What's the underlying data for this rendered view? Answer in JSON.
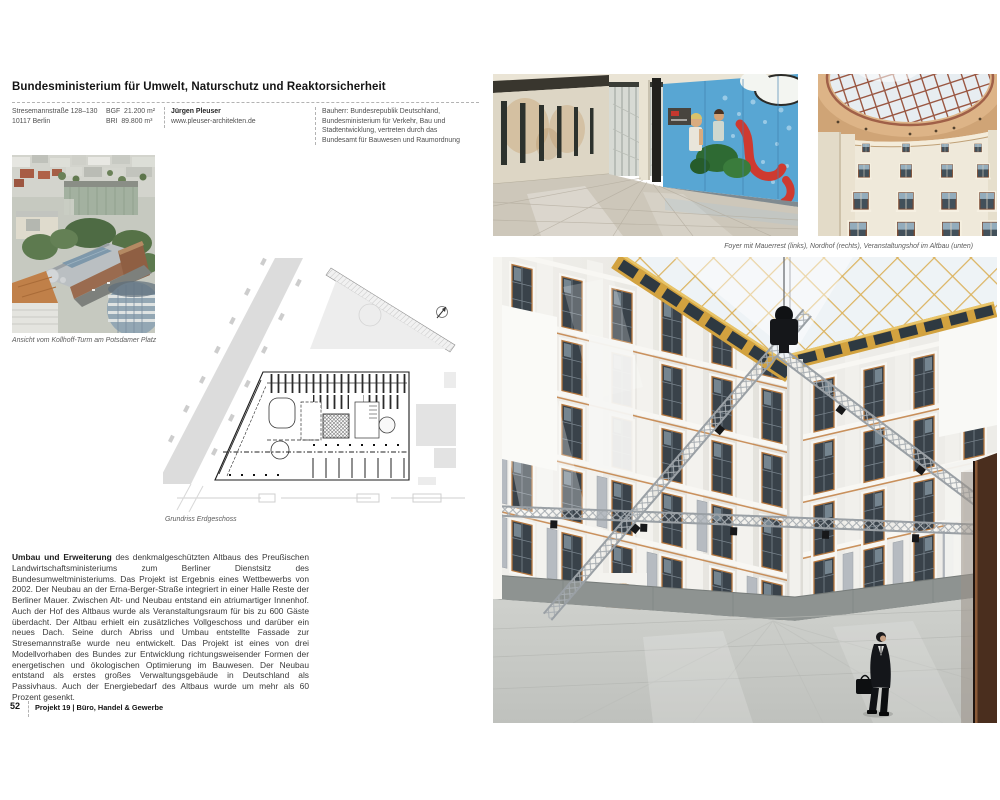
{
  "header": {
    "title": "Bundesministerium für Umwelt, Naturschutz und Reaktorsicherheit",
    "address_line1": "Stresemannstraße 128–130",
    "address_line2": "10117 Berlin",
    "metric1_label": "BGF",
    "metric1_value": "21.200 m²",
    "metric2_label": "BRI",
    "metric2_value": "89.800 m³",
    "architect_name": "Jürgen Pleuser",
    "architect_url": "www.pleuser-architekten.de",
    "client_lines": [
      "Bauherr: Bundesrepublik Deutschland,",
      "Bundesministerium für Verkehr, Bau und",
      "Stadtentwicklung, vertreten durch das",
      "Bundesamt für Bauwesen und Raumordnung"
    ]
  },
  "figures": {
    "aerial_caption": "Ansicht vom Kollhoff-Turm am Potsdamer Platz",
    "plan_caption": "Grundriss Erdgeschoss",
    "photos_caption": "Foyer mit Mauerrest (links), Nordhof (rechts), Veranstaltungshof im Altbau (unten)"
  },
  "body": {
    "lead": "Umbau und Erweiterung",
    "text": " des denkmalgeschützten Altbaus des Preußischen Landwirtschaftsministeriums zum Berliner Dienstsitz des Bundesumweltministeriums. Das Projekt ist Ergebnis eines Wettbewerbs von 2002. Der Neubau an der Erna-Berger-Straße integriert in einer Halle Reste der Berliner Mauer. Zwischen Alt- und Neubau entstand ein atriumartiger Innenhof. Auch der Hof des Altbaus wurde als Veranstaltungsraum für bis zu 600 Gäste überdacht. Der Altbau erhielt ein zusätzliches Vollgeschoss und darüber ein neues Dach. Seine durch Abriss und Umbau entstellte Fassade zur Stresemannstraße wurde neu entwickelt. Das Projekt ist eines von drei Modellvorhaben des Bundes zur Entwicklung richtungsweisender Formen der energetischen und ökologischen Optimierung im Bauwesen. Der Neubau entstand als erstes großes Verwaltungsgebäude in Deutschland als Passivhaus. Auch der Energiebedarf des Altbaus wurde um mehr als 60 Prozent gesenkt."
  },
  "footer": {
    "page_number": "52",
    "section": "Projekt 19 | Büro, Handel & Gewerbe"
  },
  "colors": {
    "accent_gold": "#d2a23f",
    "graffiti_blue": "#58a6d3",
    "graffiti_red": "#ce3a30",
    "facade_white": "#efeeea",
    "caption_grey": "#5c5c5c"
  }
}
